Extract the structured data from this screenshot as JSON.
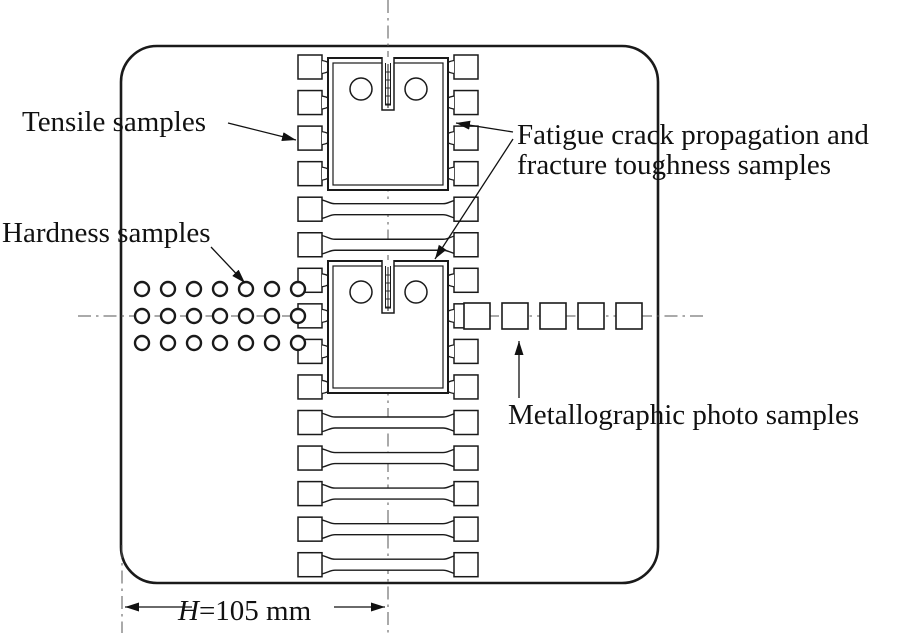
{
  "diagram": {
    "background": "#ffffff",
    "line_color": "#1a1a1a",
    "centerline_color": "#555555"
  },
  "labels": {
    "tensile": "Tensile samples",
    "hardness": "Hardness samples",
    "fatigue_line1": "Fatigue crack propagation and",
    "fatigue_line2": "fracture toughness samples",
    "metallographic": "Metallographic photo samples"
  },
  "dimension": {
    "symbol": "H",
    "rest": "=105 mm"
  },
  "samples": {
    "hardness_grid": {
      "rows": 3,
      "cols": 7
    },
    "metallographic_count": 5,
    "tensile_grip_rows": 15,
    "full_tensile_rows": [
      5,
      6,
      11,
      12,
      13,
      14,
      15
    ],
    "ct_count": 2
  }
}
